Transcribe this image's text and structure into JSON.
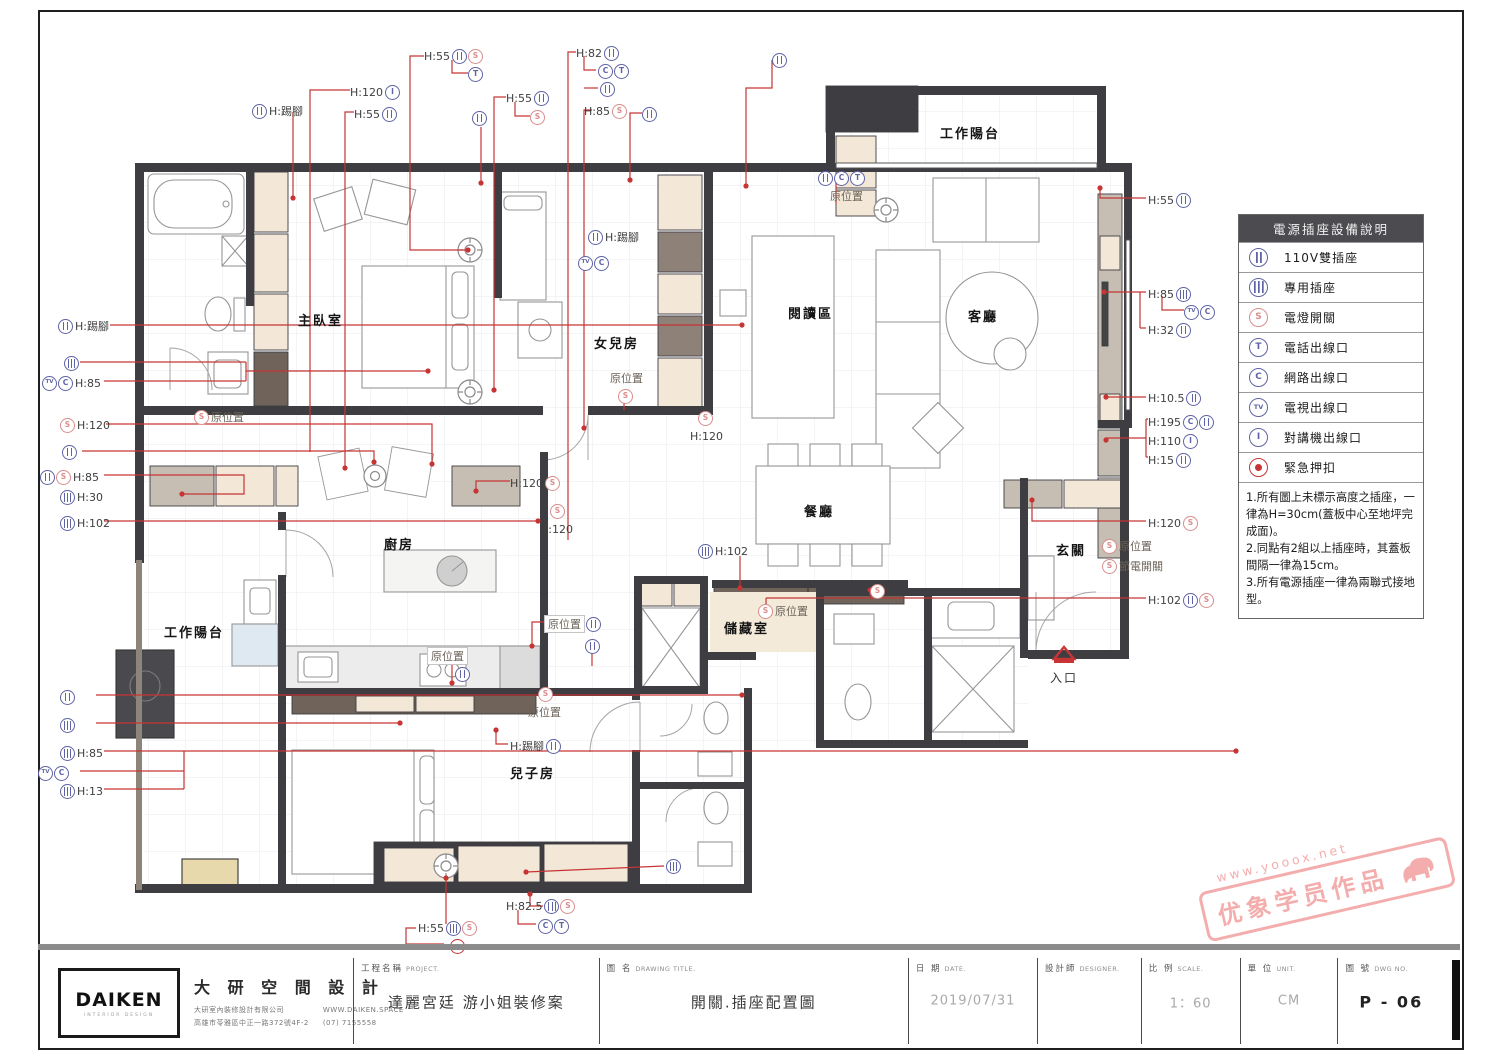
{
  "plan": {
    "symbol_glyphs": {
      "S": "S",
      "T": "T",
      "C": "C",
      "TV": "TV",
      "I": "I",
      "dup": "",
      "ded": "",
      "dot": ""
    },
    "symbol_names": {
      "S": "light-switch",
      "T": "phone-outlet",
      "C": "network-outlet",
      "TV": "tv-outlet",
      "I": "intercom-outlet",
      "dup": "duplex-outlet",
      "ded": "dedicated-outlet",
      "dot": "emergency-button"
    },
    "entrance_label": "入口",
    "rooms": [
      {
        "label": "主臥室",
        "x": 298,
        "y": 310
      },
      {
        "label": "女兒房",
        "x": 594,
        "y": 333
      },
      {
        "label": "閱讀區",
        "x": 788,
        "y": 303
      },
      {
        "label": "客廳",
        "x": 968,
        "y": 306
      },
      {
        "label": "工作陽台",
        "x": 940,
        "y": 123
      },
      {
        "label": "餐廳",
        "x": 804,
        "y": 501
      },
      {
        "label": "廚房",
        "x": 384,
        "y": 534
      },
      {
        "label": "工作陽台",
        "x": 164,
        "y": 622
      },
      {
        "label": "兒子房",
        "x": 510,
        "y": 763
      },
      {
        "label": "儲藏室",
        "x": 724,
        "y": 618
      },
      {
        "label": "玄關",
        "x": 1056,
        "y": 540
      }
    ],
    "annotations": [
      {
        "x": 252,
        "y": 103,
        "t": "H:踢腳",
        "s": [
          "dup"
        ],
        "flip": 1
      },
      {
        "x": 350,
        "y": 84,
        "t": "H:120",
        "s": [
          "I"
        ]
      },
      {
        "x": 354,
        "y": 106,
        "t": "H:55",
        "s": [
          "dup"
        ]
      },
      {
        "x": 424,
        "y": 48,
        "t": "H:55",
        "s": [
          "dup",
          "S"
        ]
      },
      {
        "x": 468,
        "y": 66,
        "t": "",
        "s": [
          "T"
        ]
      },
      {
        "x": 472,
        "y": 110,
        "t": "",
        "s": [
          "dup"
        ]
      },
      {
        "x": 506,
        "y": 90,
        "t": "H:55",
        "s": [
          "dup"
        ]
      },
      {
        "x": 530,
        "y": 109,
        "t": "",
        "s": [
          "S"
        ]
      },
      {
        "x": 576,
        "y": 45,
        "t": "H:82",
        "s": [
          "dup"
        ]
      },
      {
        "x": 598,
        "y": 63,
        "t": "",
        "s": [
          "C",
          "T"
        ]
      },
      {
        "x": 600,
        "y": 81,
        "t": "",
        "s": [
          "dup"
        ]
      },
      {
        "x": 584,
        "y": 103,
        "t": "H:85",
        "s": [
          "S"
        ]
      },
      {
        "x": 642,
        "y": 106,
        "t": "",
        "s": [
          "dup"
        ]
      },
      {
        "x": 772,
        "y": 52,
        "t": "",
        "s": [
          "dup"
        ]
      },
      {
        "x": 818,
        "y": 170,
        "t": "",
        "s": [
          "dup",
          "C",
          "T"
        ]
      },
      {
        "x": 830,
        "y": 188,
        "t": "原位置",
        "s": [],
        "cls": "gray"
      },
      {
        "x": 1148,
        "y": 192,
        "t": "H:55",
        "s": [
          "dup"
        ]
      },
      {
        "x": 1148,
        "y": 286,
        "t": "H:85",
        "s": [
          "ded"
        ]
      },
      {
        "x": 1184,
        "y": 304,
        "t": "",
        "s": [
          "TV",
          "C"
        ]
      },
      {
        "x": 1148,
        "y": 322,
        "t": "H:32",
        "s": [
          "dup"
        ]
      },
      {
        "x": 1148,
        "y": 390,
        "t": "H:10.5",
        "s": [
          "dup"
        ]
      },
      {
        "x": 1148,
        "y": 414,
        "t": "H:195",
        "s": [
          "C",
          "dup"
        ]
      },
      {
        "x": 1148,
        "y": 433,
        "t": "H:110",
        "s": [
          "I"
        ]
      },
      {
        "x": 1148,
        "y": 452,
        "t": "H:15",
        "s": [
          "dup"
        ]
      },
      {
        "x": 1148,
        "y": 515,
        "t": "H:120",
        "s": [
          "S"
        ]
      },
      {
        "x": 1102,
        "y": 538,
        "t": "原位置",
        "s": [
          "S"
        ],
        "flip": 1,
        "cls": "gray"
      },
      {
        "x": 1102,
        "y": 558,
        "t": "節電開關",
        "s": [
          "S"
        ],
        "flip": 1,
        "cls": "gray"
      },
      {
        "x": 1148,
        "y": 592,
        "t": "H:102",
        "s": [
          "dup",
          "S"
        ]
      },
      {
        "x": 58,
        "y": 318,
        "t": "H:踢腳",
        "s": [
          "dup"
        ],
        "flip": 1
      },
      {
        "x": 64,
        "y": 355,
        "t": "",
        "s": [
          "ded"
        ],
        "flip": 1
      },
      {
        "x": 42,
        "y": 375,
        "t": "H:85",
        "s": [
          "TV",
          "C"
        ],
        "flip": 1
      },
      {
        "x": 60,
        "y": 417,
        "t": "H:120",
        "s": [
          "S"
        ],
        "flip": 1
      },
      {
        "x": 194,
        "y": 409,
        "t": "原位置",
        "s": [
          "S"
        ],
        "flip": 1,
        "cls": "gray"
      },
      {
        "x": 62,
        "y": 444,
        "t": "",
        "s": [
          "dup"
        ],
        "flip": 1
      },
      {
        "x": 40,
        "y": 469,
        "t": "H:85",
        "s": [
          "dup",
          "S"
        ],
        "flip": 1
      },
      {
        "x": 60,
        "y": 489,
        "t": "H:30",
        "s": [
          "ded"
        ],
        "flip": 1
      },
      {
        "x": 60,
        "y": 515,
        "t": "H:102",
        "s": [
          "ded"
        ],
        "flip": 1
      },
      {
        "x": 60,
        "y": 689,
        "t": "",
        "s": [
          "dup"
        ],
        "flip": 1
      },
      {
        "x": 60,
        "y": 717,
        "t": "",
        "s": [
          "ded"
        ],
        "flip": 1
      },
      {
        "x": 60,
        "y": 745,
        "t": "H:85",
        "s": [
          "ded"
        ],
        "flip": 1
      },
      {
        "x": 38,
        "y": 765,
        "t": "",
        "s": [
          "TV",
          "C"
        ],
        "flip": 1
      },
      {
        "x": 60,
        "y": 783,
        "t": "H:13",
        "s": [
          "ded"
        ],
        "flip": 1
      },
      {
        "x": 510,
        "y": 475,
        "t": "H:120",
        "s": [
          "S"
        ]
      },
      {
        "x": 550,
        "y": 503,
        "t": "",
        "s": [
          "S"
        ]
      },
      {
        "x": 540,
        "y": 521,
        "t": "H:120",
        "s": []
      },
      {
        "x": 610,
        "y": 370,
        "t": "原位置",
        "s": [],
        "cls": "gray"
      },
      {
        "x": 618,
        "y": 388,
        "t": "",
        "s": [
          "S"
        ]
      },
      {
        "x": 698,
        "y": 410,
        "t": "",
        "s": [
          "S"
        ]
      },
      {
        "x": 690,
        "y": 428,
        "t": "H:120",
        "s": []
      },
      {
        "x": 588,
        "y": 229,
        "t": "H:踢腳",
        "s": [
          "dup"
        ],
        "flip": 1
      },
      {
        "x": 578,
        "y": 255,
        "t": "",
        "s": [
          "TV",
          "C"
        ],
        "flip": 1
      },
      {
        "x": 428,
        "y": 648,
        "t": "原位置",
        "s": [],
        "cls": "gray",
        "boxed": 1
      },
      {
        "x": 455,
        "y": 666,
        "t": "",
        "s": [
          "dup"
        ],
        "flip": 1
      },
      {
        "x": 545,
        "y": 616,
        "t": "原位置",
        "s": [
          "dup"
        ],
        "cls": "gray",
        "boxed": 1
      },
      {
        "x": 585,
        "y": 638,
        "t": "",
        "s": [
          "dup"
        ],
        "flip": 1
      },
      {
        "x": 538,
        "y": 686,
        "t": "",
        "s": [
          "S"
        ],
        "flip": 1
      },
      {
        "x": 528,
        "y": 704,
        "t": "原位置",
        "s": [],
        "cls": "gray"
      },
      {
        "x": 510,
        "y": 738,
        "t": "H:踢腳",
        "s": [
          "dup"
        ]
      },
      {
        "x": 698,
        "y": 543,
        "t": "H:102",
        "s": [
          "ded"
        ],
        "flip": 1
      },
      {
        "x": 758,
        "y": 603,
        "t": "原位置",
        "s": [
          "S"
        ],
        "flip": 1,
        "cls": "gray"
      },
      {
        "x": 870,
        "y": 583,
        "t": "",
        "s": [
          "S"
        ],
        "flip": 1
      },
      {
        "x": 418,
        "y": 920,
        "t": "H:55",
        "s": [
          "ded",
          "S"
        ]
      },
      {
        "x": 450,
        "y": 938,
        "t": "",
        "s": [
          "dot"
        ],
        "flip": 1
      },
      {
        "x": 506,
        "y": 898,
        "t": "H:82.5",
        "s": [
          "ded",
          "S"
        ]
      },
      {
        "x": 538,
        "y": 918,
        "t": "",
        "s": [
          "C",
          "T"
        ],
        "flip": 1
      },
      {
        "x": 666,
        "y": 858,
        "t": "",
        "s": [
          "ded"
        ],
        "flip": 1
      }
    ]
  },
  "legend": {
    "title": "電源插座設備說明",
    "rows": [
      {
        "sym": "dup",
        "label": "110V雙插座"
      },
      {
        "sym": "ded",
        "label": "專用插座"
      },
      {
        "sym": "S",
        "label": "電燈開關"
      },
      {
        "sym": "T",
        "label": "電話出線口"
      },
      {
        "sym": "C",
        "label": "網路出線口"
      },
      {
        "sym": "TV",
        "label": "電視出線口"
      },
      {
        "sym": "I",
        "label": "對講機出線口"
      },
      {
        "sym": "dot",
        "label": "緊急押扣"
      }
    ],
    "notes": "1.所有圖上未標示高度之插座，一律為H=30cm(蓋板中心至地坪完成面)。\n2.同點有2組以上插座時，其蓋板間隔一律為15cm。\n3.所有電源插座一律為兩聯式接地型。"
  },
  "title_block": {
    "logo_text": "DAIKEN",
    "logo_sub": "INTERIOR DESIGN",
    "brand": "大 研 空 間 設 計",
    "company": "大研室內裝修設計有限公司",
    "address": "高雄市苓雅區中正一路372號4F-2",
    "website": "WWW.DAIKEN.SPACE",
    "phone": "(07) 7155558",
    "fields": {
      "project": {
        "label": "工程名稱",
        "en": "PROJECT.",
        "value": "達麗宮廷 游小姐裝修案"
      },
      "drawing": {
        "label": "圖 名",
        "en": "DRAWING TITLE.",
        "value": "開關.插座配置圖"
      },
      "date": {
        "label": "日 期",
        "en": "DATE.",
        "value": "2019/07/31"
      },
      "designer": {
        "label": "設計師",
        "en": "DESIGNER.",
        "value": ""
      },
      "scale": {
        "label": "比 例",
        "en": "SCALE.",
        "value": "1：60"
      },
      "unit": {
        "label": "單 位",
        "en": "UNIT.",
        "value": "CM"
      },
      "dwg": {
        "label": "圖 號",
        "en": "DWG NO.",
        "value": "P - 06"
      }
    }
  },
  "watermark": {
    "url": "www.yooox.net",
    "text": "优象学员作品"
  }
}
